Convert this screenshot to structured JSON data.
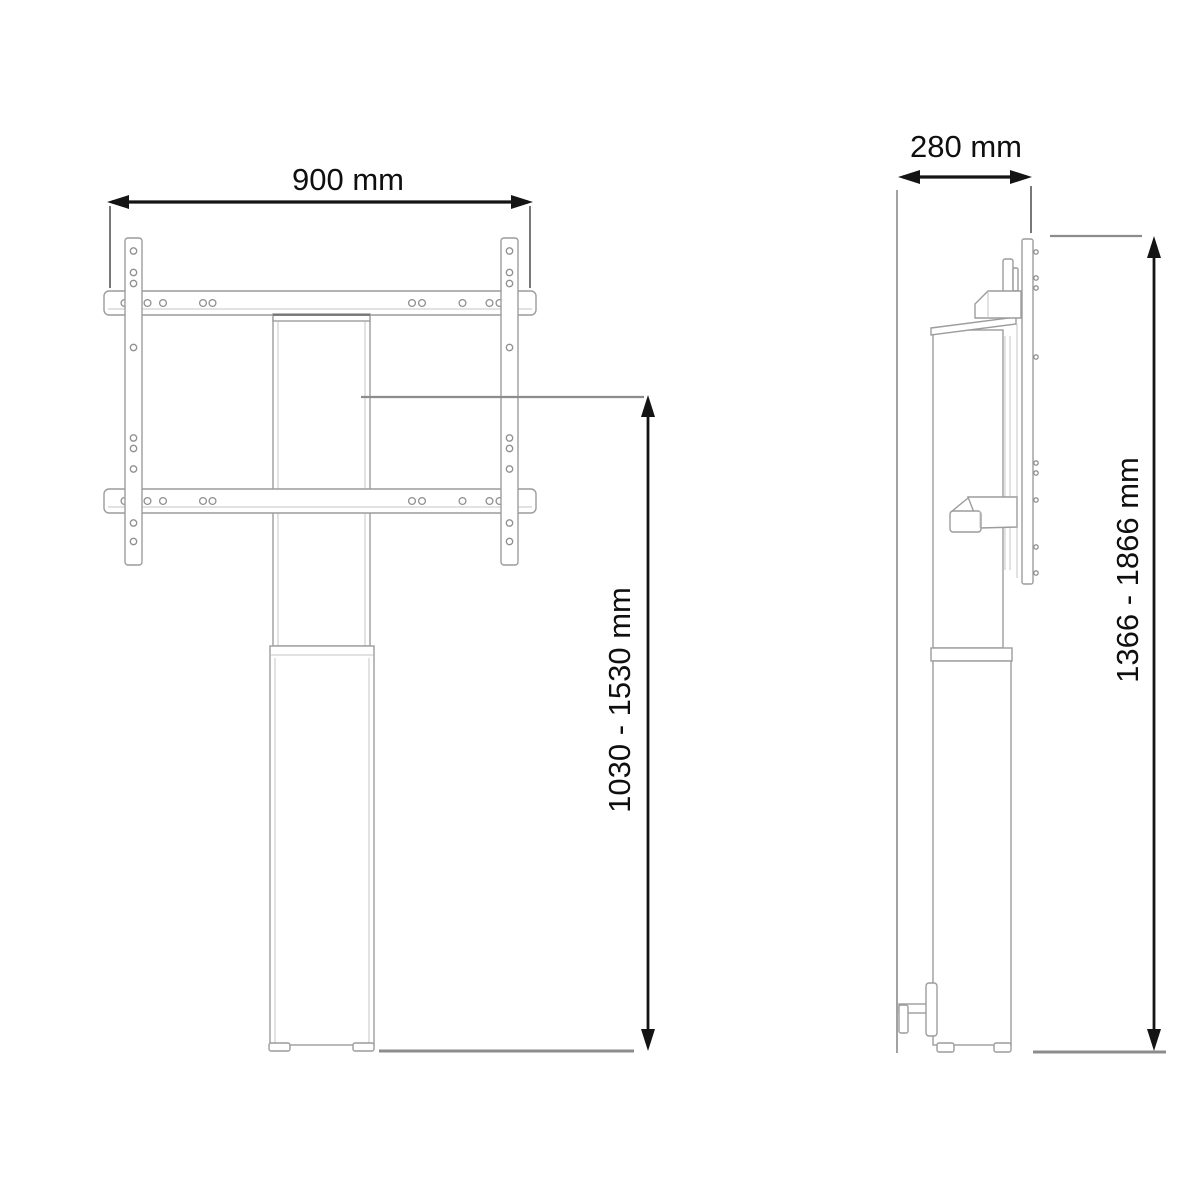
{
  "diagram": {
    "front_view": {
      "width_label": "900 mm",
      "height_label": "1030 - 1530 mm"
    },
    "side_view": {
      "depth_label": "280 mm",
      "height_label": "1366 - 1866 mm"
    },
    "colors": {
      "background": "#ffffff",
      "outline_gray": "#9c9c9c",
      "dimension_black": "#141414"
    }
  }
}
